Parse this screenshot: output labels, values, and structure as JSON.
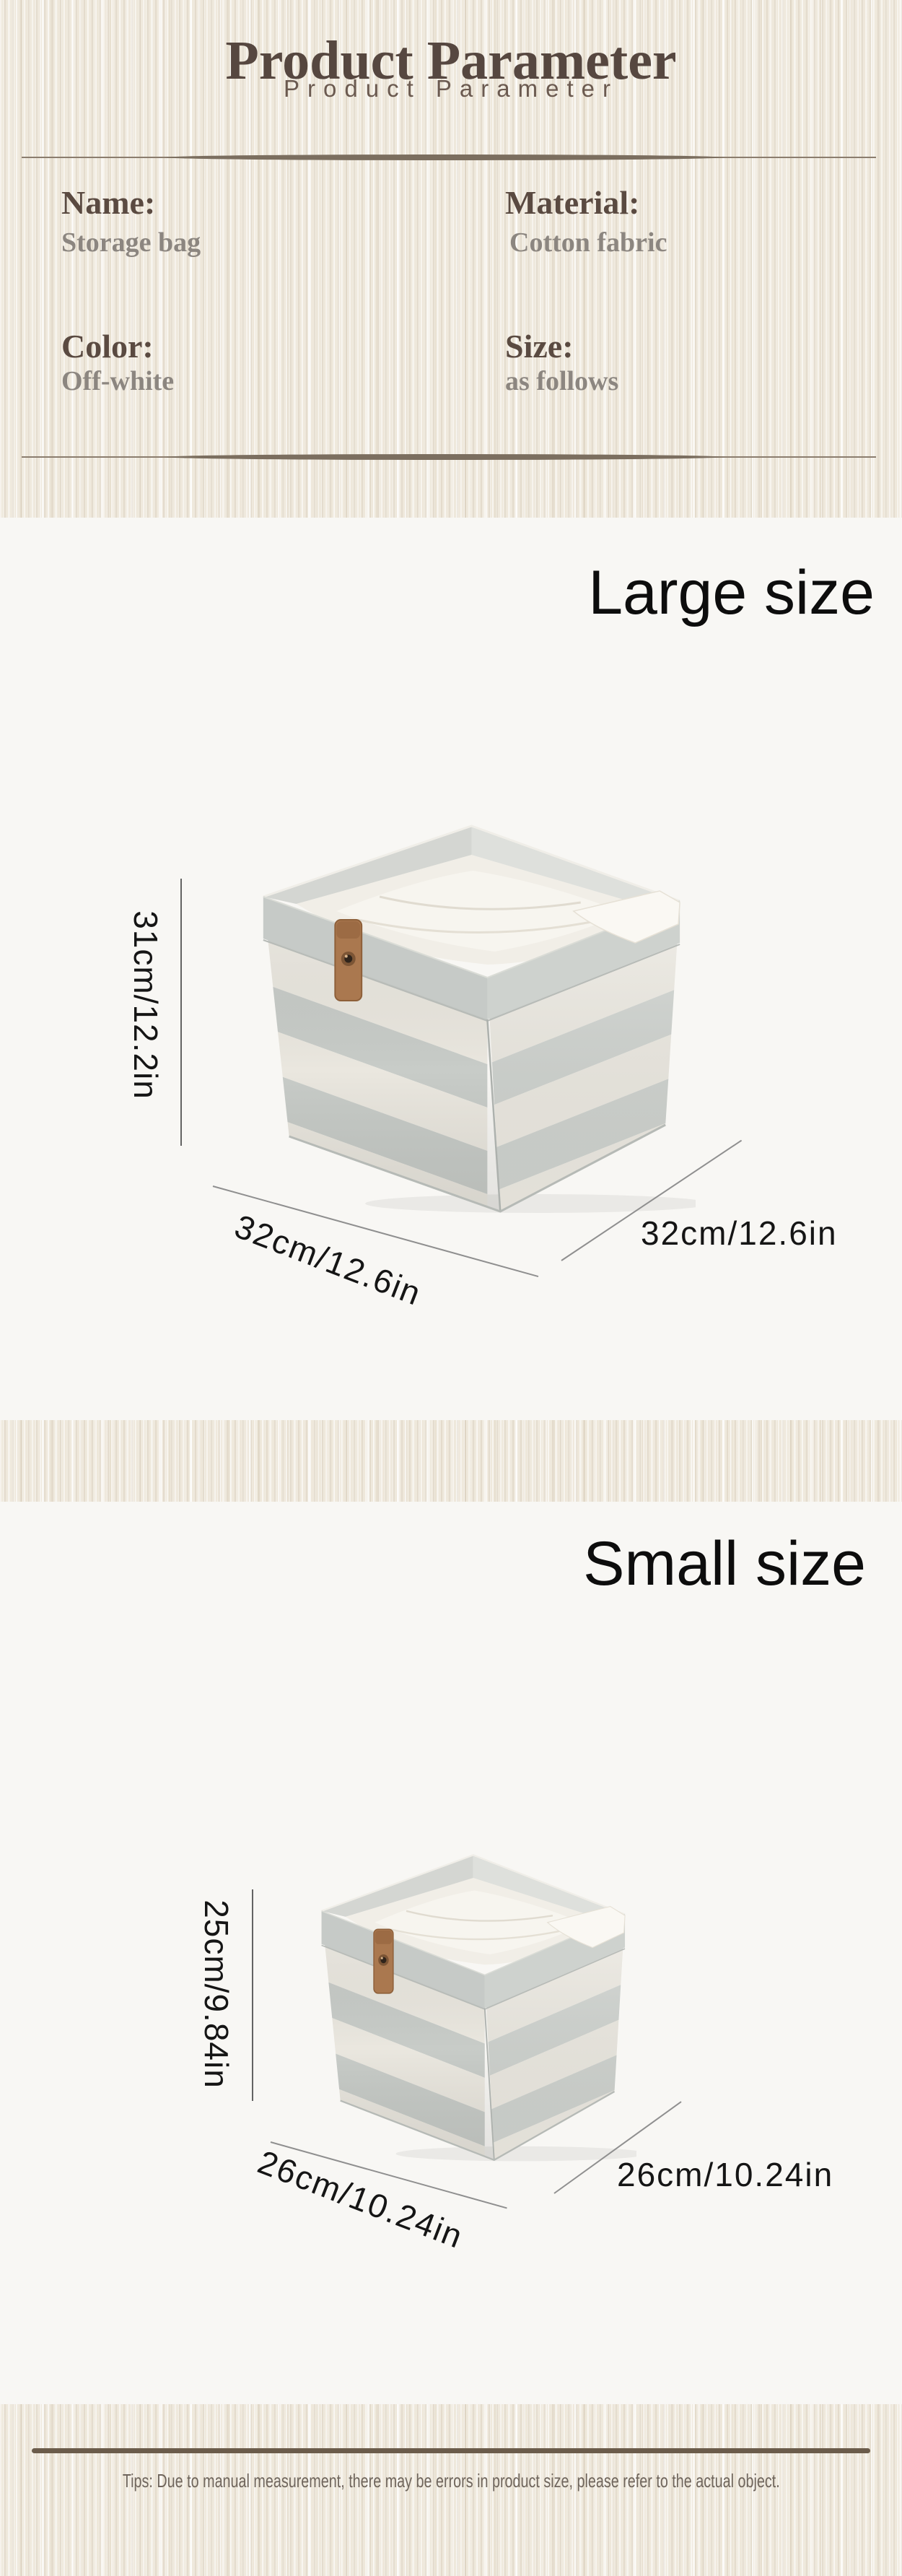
{
  "header": {
    "title": "Product Parameter",
    "subtitle": "Product Parameter"
  },
  "parameters": [
    {
      "label": "Name:",
      "value": "Storage bag"
    },
    {
      "label": "Material:",
      "value": "Cotton fabric"
    },
    {
      "label": "Color:",
      "value": "Off-white"
    },
    {
      "label": "Size:",
      "value": "as follows"
    }
  ],
  "sections": {
    "large": {
      "title": "Large size",
      "height_label": "31cm/12.2in",
      "width_label": "32cm/12.6in",
      "depth_label": "32cm/12.6in"
    },
    "small": {
      "title": "Small size",
      "height_label": "25cm/9.84in",
      "width_label": "26cm/10.24in",
      "depth_label": "26cm/10.24in"
    }
  },
  "product": {
    "illustration": "striped-fabric-storage-box-with-folded-linens-and-leather-tab"
  },
  "footer": {
    "tips": "Tips: Due to manual measurement, there may be errors in product size, please refer to the actual object."
  },
  "colors": {
    "texture_background": "#efe9dd",
    "panel_background": "#f8f7f4",
    "heading_brown": "#564740",
    "subtitle_brown": "#6b5a50",
    "param_label_brown": "#5a4a41",
    "param_value_gray": "#8c8680",
    "divider_brown": "#7b6e5f",
    "size_text_black": "#0d0d0d",
    "dimension_line_gray": "#8f8f8f",
    "footer_line_brown": "#6b5c4b",
    "tips_text_brown": "#6f655c",
    "box_stripe_gray": "#c8ccc8",
    "box_stripe_cream": "#eae7df",
    "leather_tab_brown": "#aa784f"
  }
}
